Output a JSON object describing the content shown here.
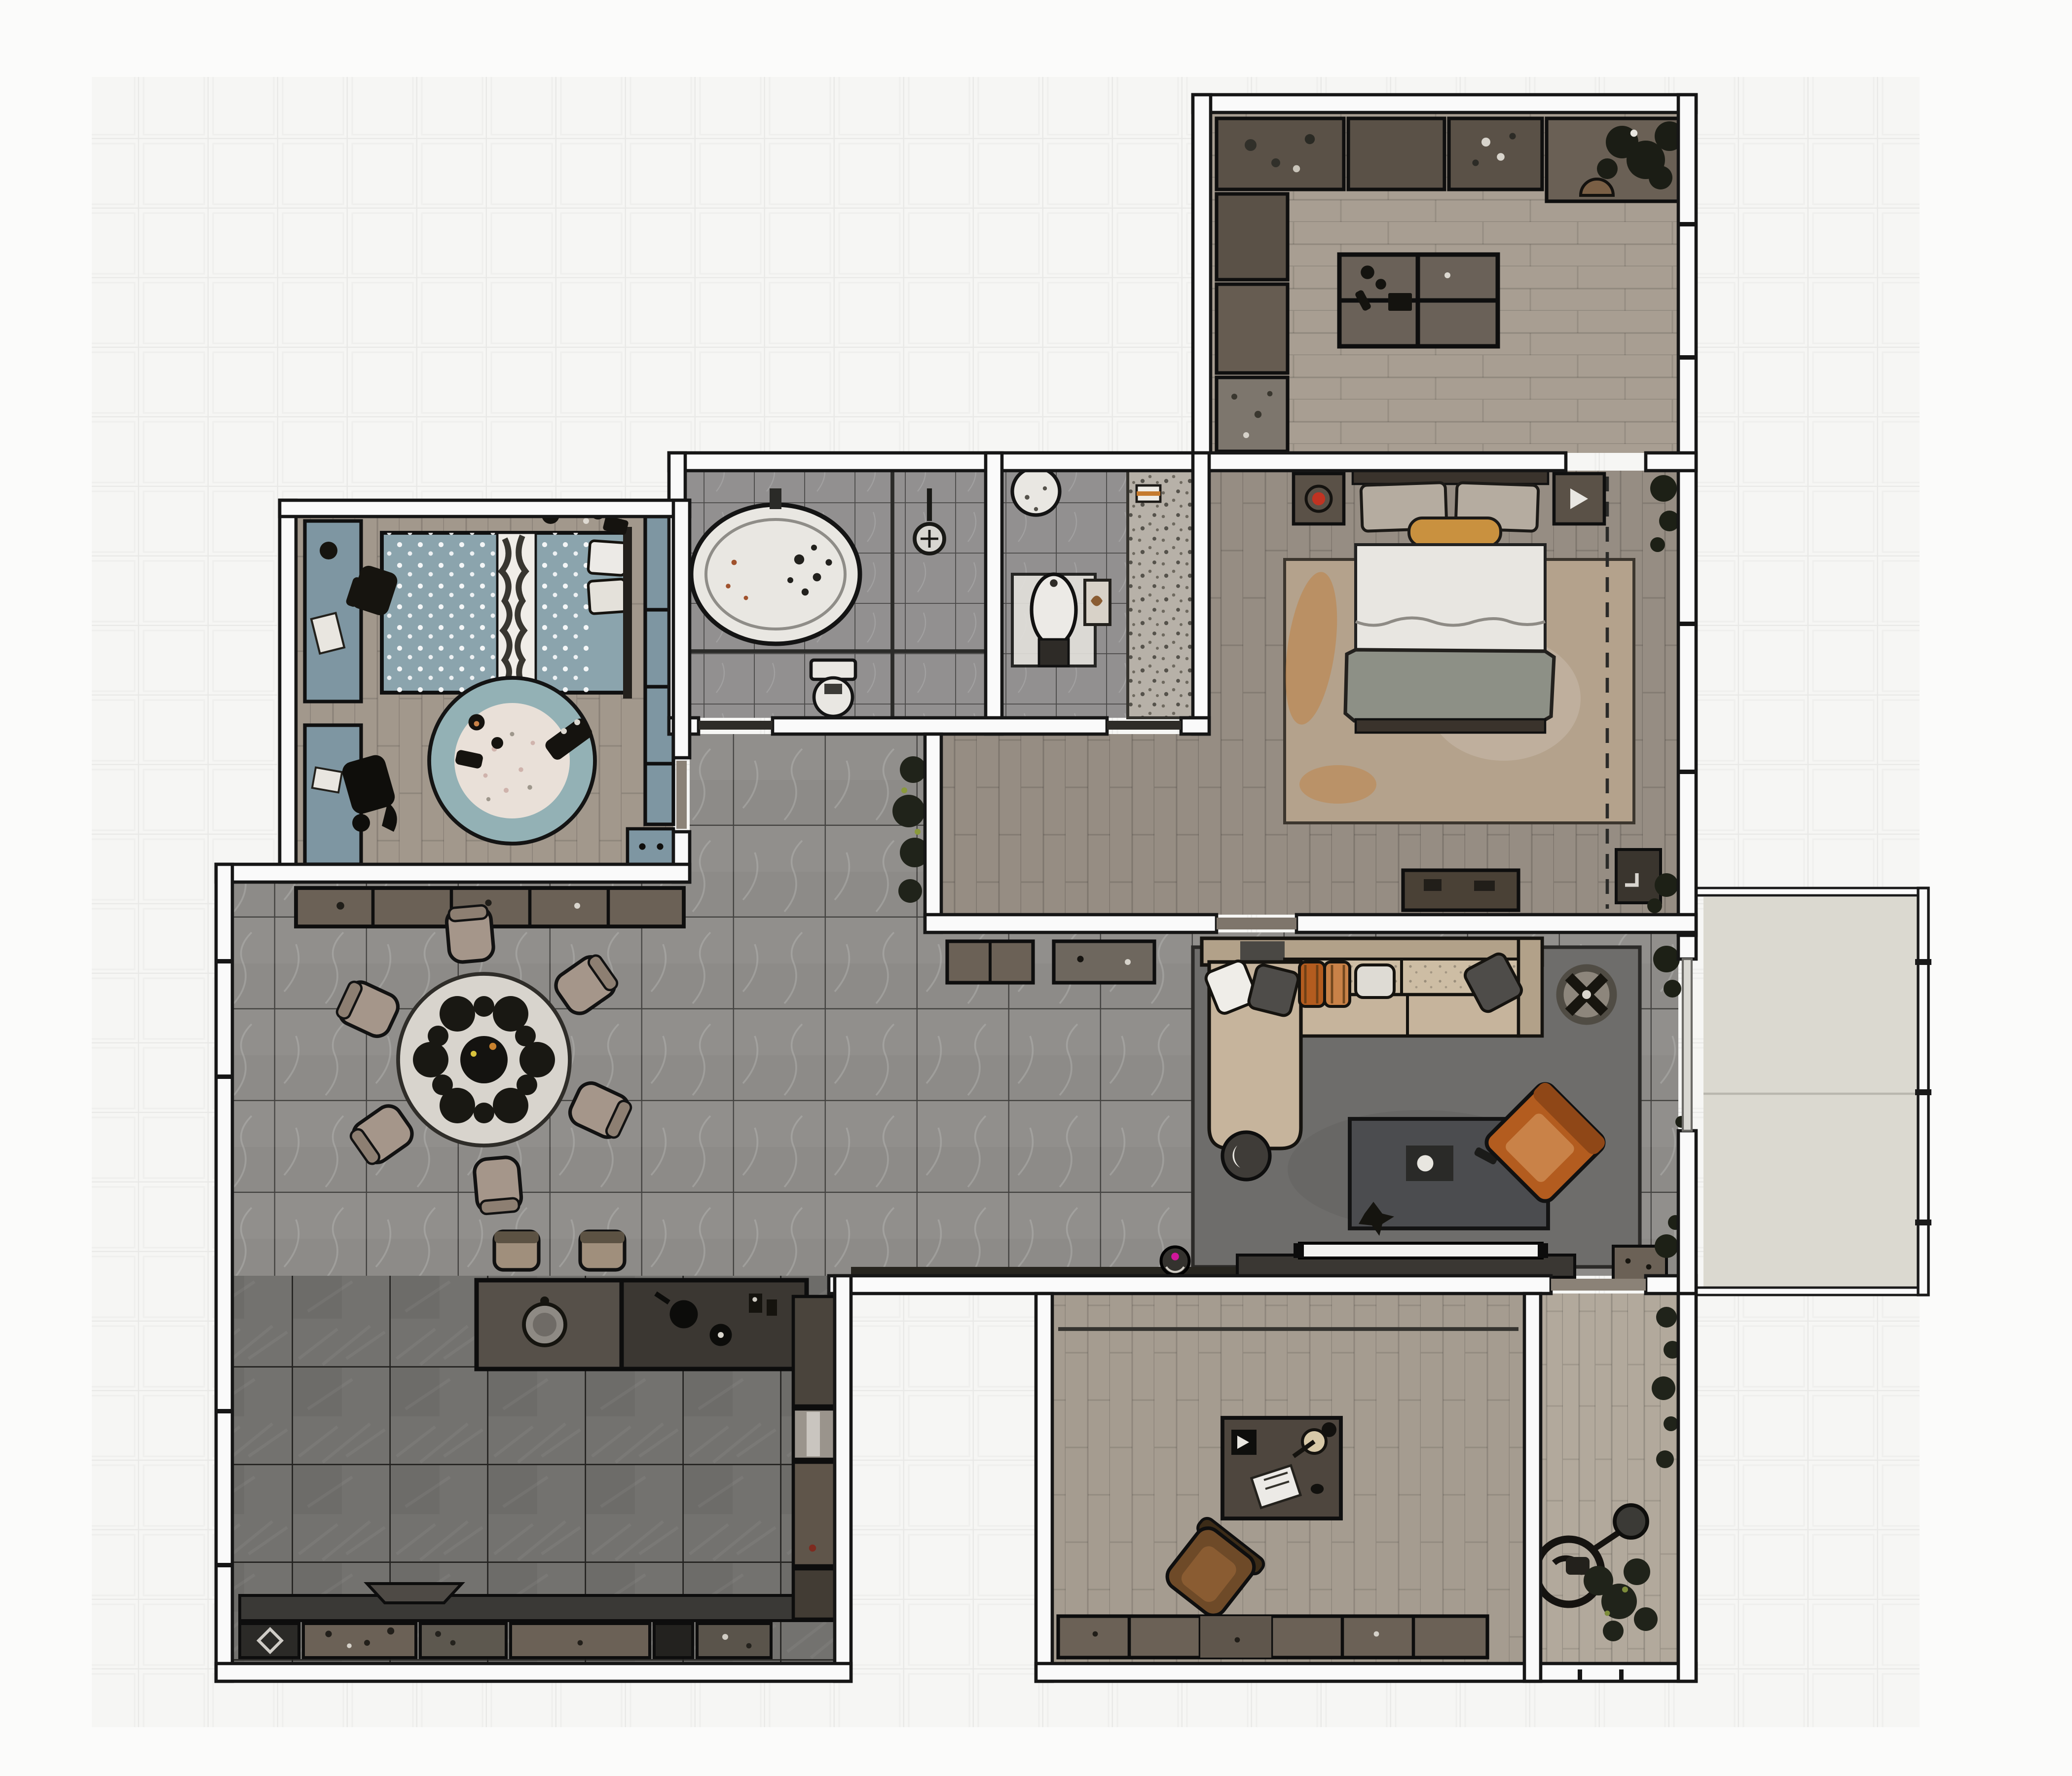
{
  "app": {
    "type": "floor-plan-render",
    "visible_text": []
  },
  "palette": {
    "page_bg": "#fbfbfa",
    "grid_bg": "#f6f6f4",
    "grid_line": "#e9e9e7",
    "wall_fill": "#fafafa",
    "wall_stroke": "#161616",
    "marble_floor": "#8d8b88",
    "marble_line": "#434240",
    "bath_floor": "#929090",
    "slate_floor": "#73726f",
    "wood_bedroom": "#968d83",
    "wood_office": "#a89e92",
    "wood_study": "#a59c90",
    "wood_child": "#a2988c",
    "wood_entry": "#b2a99c",
    "balcony_floor": "#dbd9d0",
    "teal": "#7e96a2",
    "teal_duvet": "#8ba4ad",
    "rug_child_ring": "#93b1b5",
    "rug_child_center": "#e9e0d8",
    "rug_living": "#6e6d6b",
    "rug_bedroom": "#b4a28c",
    "rug_accent_orange": "#c27a33",
    "sofa": "#c6b49c",
    "sofa_frame": "#b2a189",
    "armchair": "#b35c1f",
    "armchair_light": "#c98248",
    "cabinet_brown": "#6b6156",
    "cabinet_dark": "#5a5147",
    "counter_black": "#3b3732",
    "island_gray": "#565049",
    "table_top": "#d8d4cd",
    "chair_tan": "#a5968a",
    "bed_white": "#e8e6e1",
    "blanket_gray": "#8d9086",
    "bolster_orange": "#c9913f",
    "tv_screen": "#f2f2f0",
    "coffee_table": "#4b4c4f",
    "vacuum_accent": "#d0169a",
    "lamp_red": "#c03322",
    "plant_dark": "#20231a"
  },
  "rooms": [
    {
      "id": "office",
      "floor": "wood_office",
      "furniture": [
        "counter-run",
        "counter-island",
        "stool",
        "plant"
      ]
    },
    {
      "id": "master-bedroom",
      "floor": "wood_bedroom",
      "furniture": [
        "double-bed",
        "nightstands",
        "area-rug",
        "dresser",
        "doormat",
        "closet-dashed-line",
        "plants"
      ]
    },
    {
      "id": "bathroom",
      "floor": "bath_floor",
      "furniture": [
        "bathtub",
        "shower",
        "toilet"
      ]
    },
    {
      "id": "shower-room",
      "floor": "bath_floor",
      "furniture": [
        "walk-in-shower",
        "pedestal-basin",
        "corner-basin",
        "wall-frame",
        "towel"
      ]
    },
    {
      "id": "kids-room",
      "floor": "wood_child",
      "furniture": [
        "kids-bed",
        "desk-upper",
        "desk-lower",
        "desk-chairs",
        "wardrobe",
        "nightstand",
        "round-rug",
        "toys"
      ]
    },
    {
      "id": "corridor",
      "floor": "marble_floor",
      "furniture": [
        "potted-plants"
      ]
    },
    {
      "id": "dining-area",
      "floor": "marble_floor",
      "furniture": [
        "dining-table",
        "dining-chairs",
        "sideboard",
        "bar-stools"
      ]
    },
    {
      "id": "kitchen",
      "floor": "slate_floor",
      "furniture": [
        "island-counter",
        "sink",
        "cooktop",
        "base-cabinets",
        "tall-cabinets",
        "counter-strip"
      ]
    },
    {
      "id": "living-area",
      "floor": "marble_floor",
      "furniture": [
        "sectional-sofa",
        "pillows",
        "side-table",
        "coffee-table",
        "armchair",
        "planter",
        "tv-console",
        "tv",
        "media-cabinet",
        "robot-vacuum",
        "credenzas",
        "plants"
      ]
    },
    {
      "id": "study",
      "floor": "wood_study",
      "furniture": [
        "desk",
        "office-chair",
        "low-cabinets",
        "door-track"
      ]
    },
    {
      "id": "entry-hall",
      "floor": "wood_entry",
      "furniture": [
        "coat-stand",
        "mirror-disc",
        "plants"
      ]
    },
    {
      "id": "balcony",
      "floor": "balcony_floor",
      "furniture": [
        "railing"
      ]
    }
  ]
}
